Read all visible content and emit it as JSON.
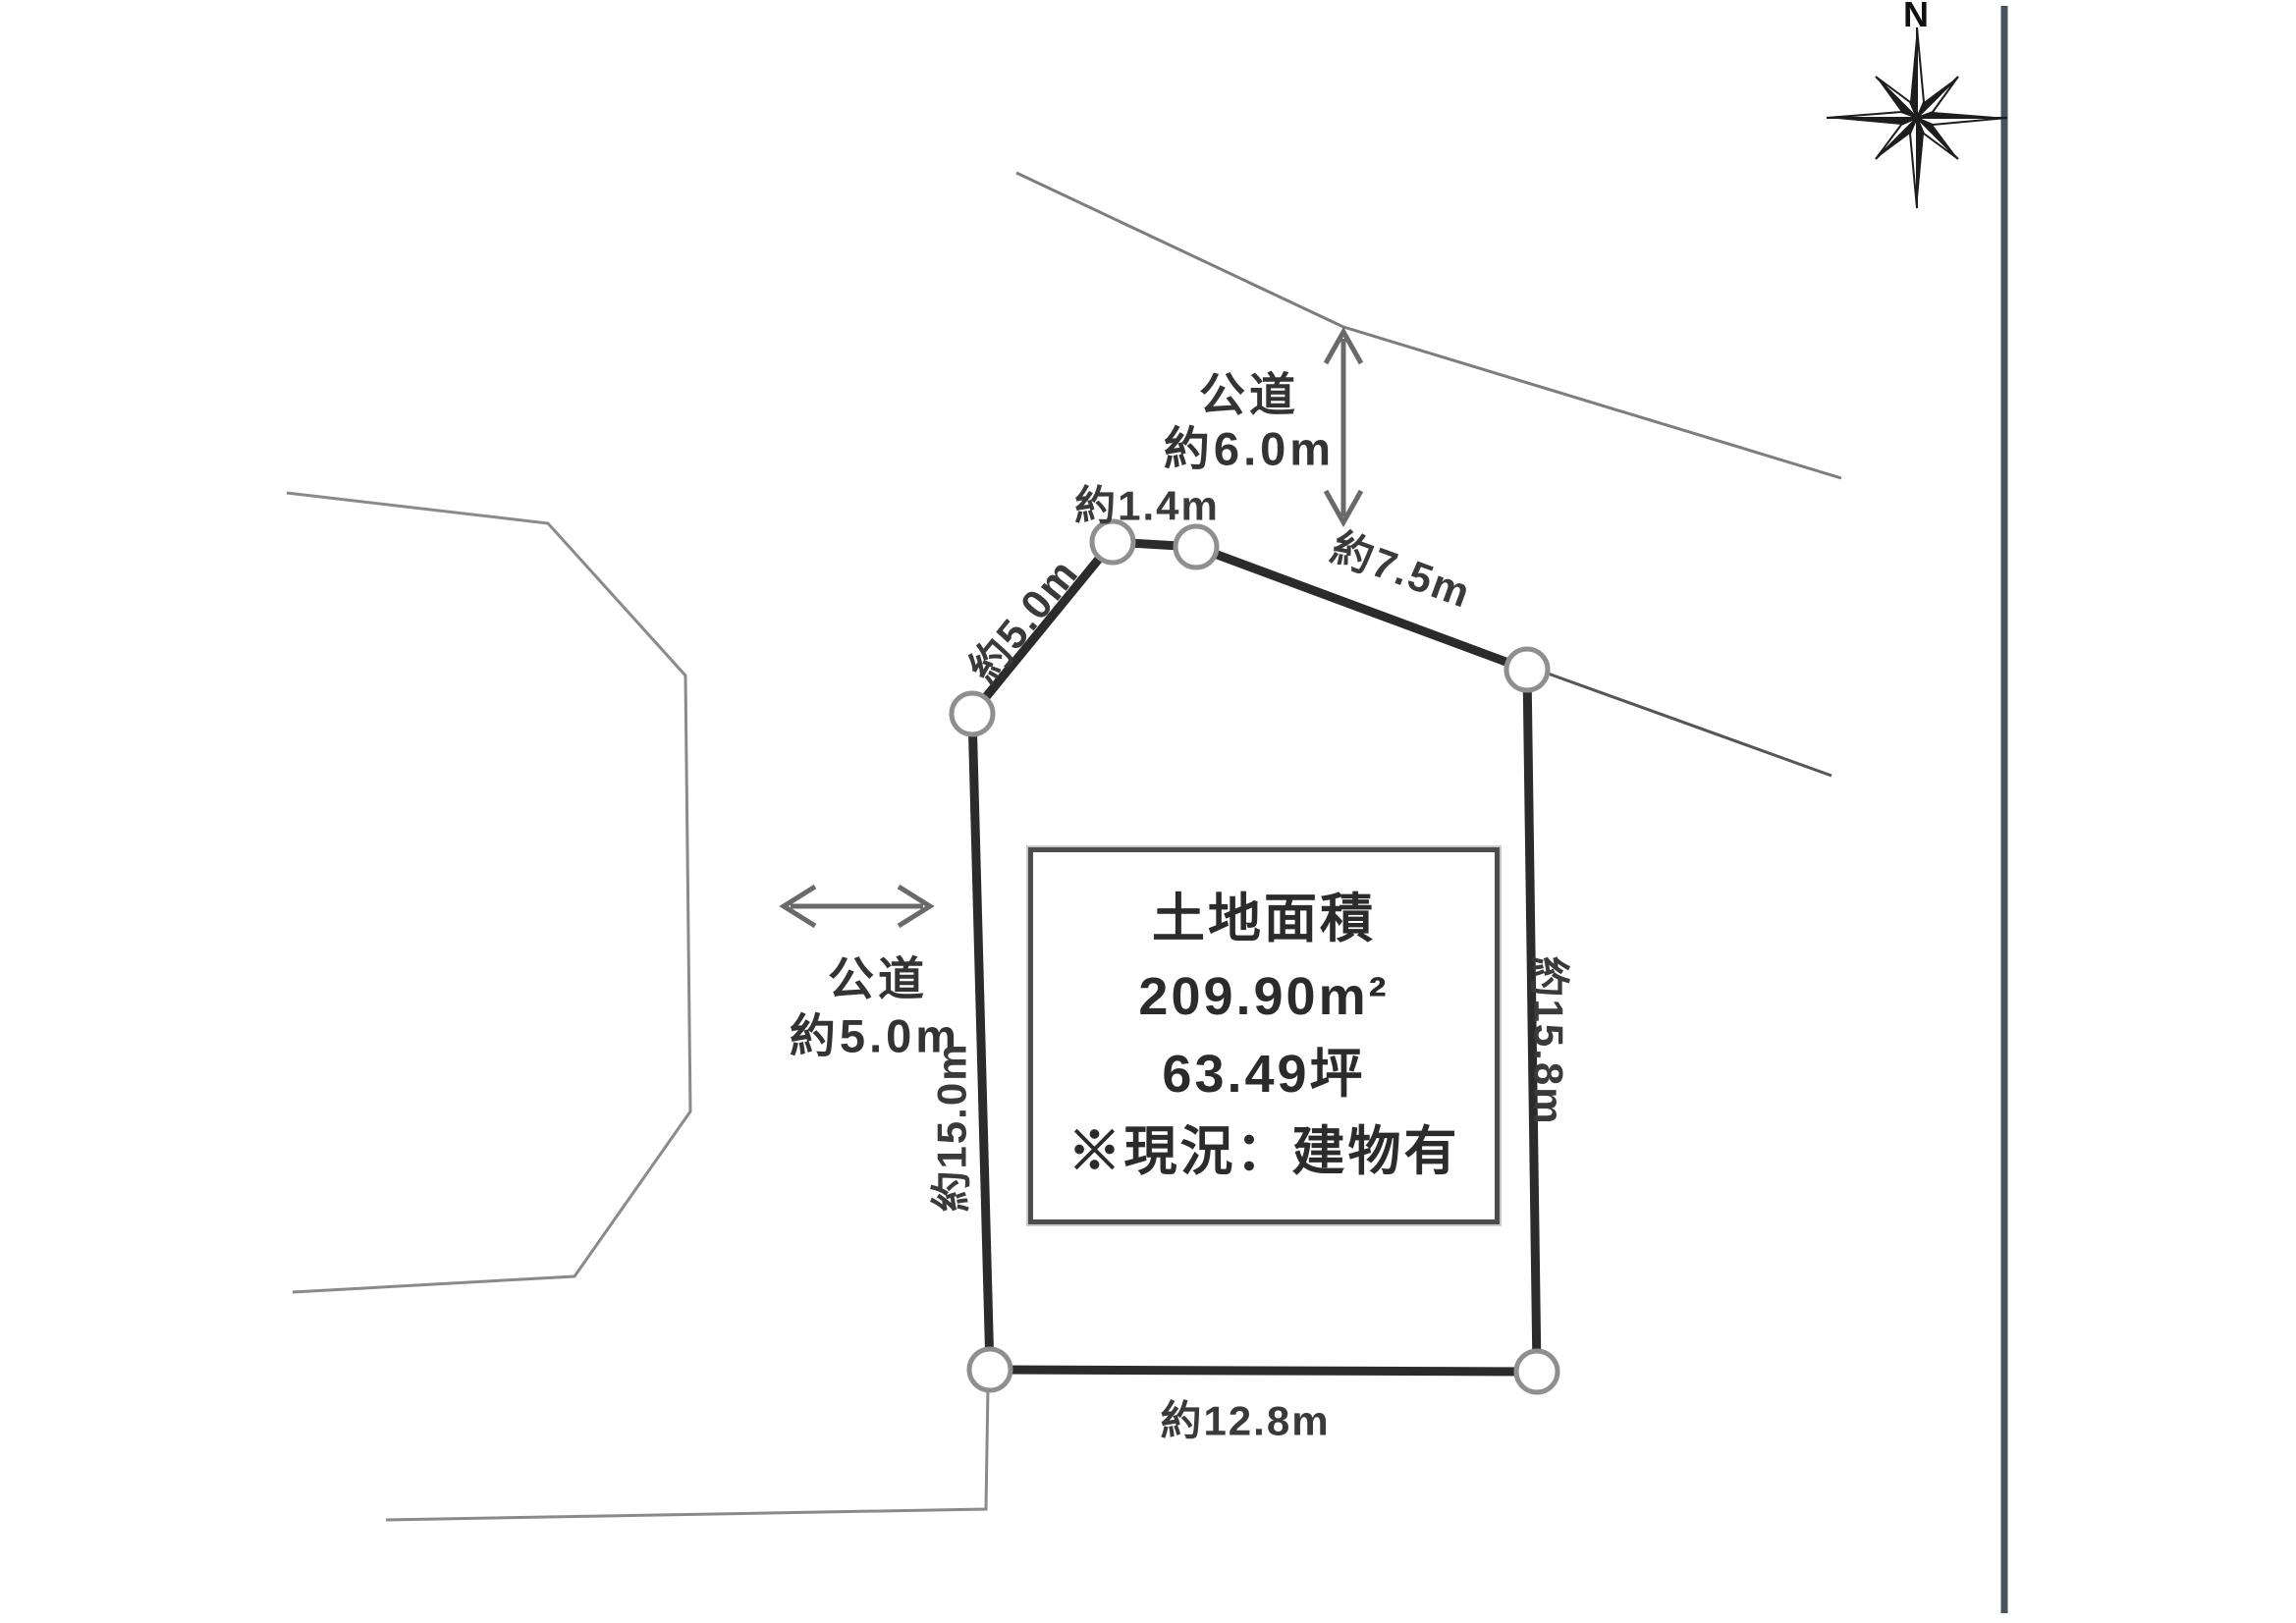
{
  "compass": {
    "north_label": "N"
  },
  "roads": {
    "top": {
      "name": "公道",
      "width": "約6.0m"
    },
    "left": {
      "name": "公道",
      "width": "約5.0m"
    }
  },
  "parcel": {
    "info_box": {
      "title": "土地面積",
      "area_sqm": "209.90m²",
      "area_tsubo": "63.49坪",
      "note": "※現況：建物有"
    },
    "edges": {
      "upper_left_diagonal": "約5.0m",
      "top_short": "約1.4m",
      "upper_right_diagonal": "約7.5m",
      "right_side": "約15.8m",
      "left_side": "約15.0m",
      "bottom": "約12.8m"
    }
  }
}
